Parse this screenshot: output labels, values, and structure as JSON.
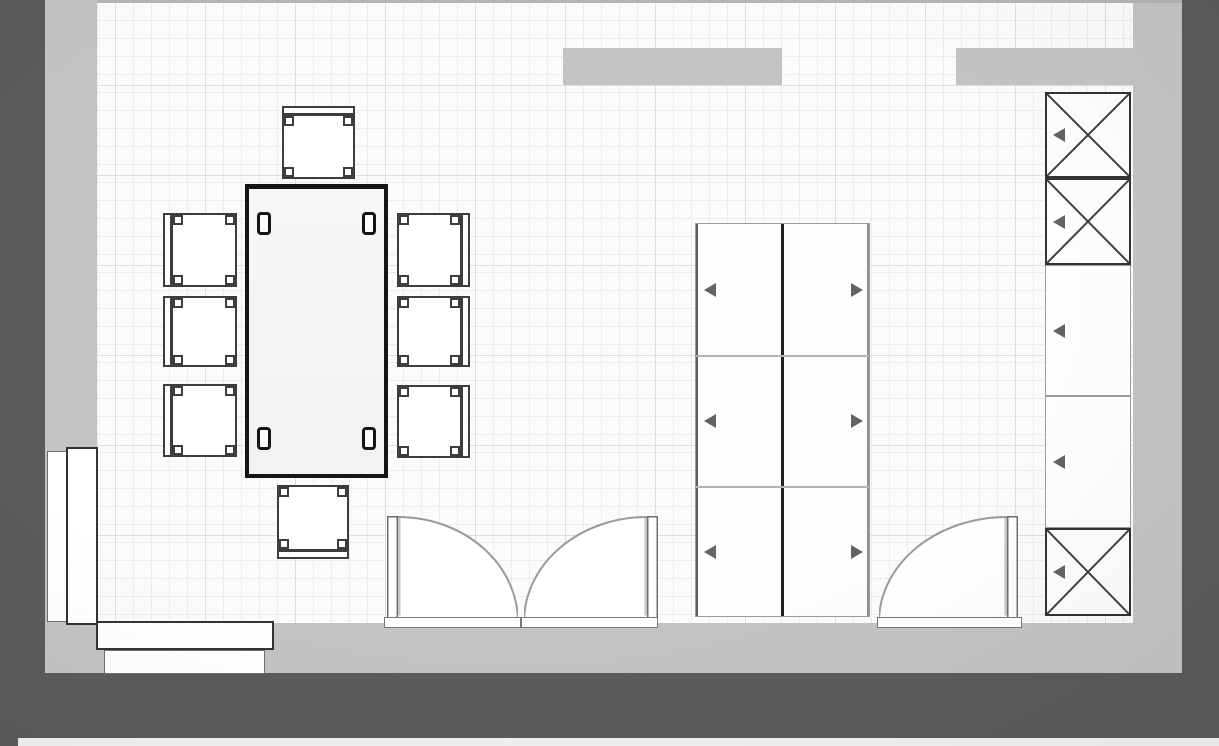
{
  "canvas": {
    "width": 1219,
    "height": 746
  },
  "colors": {
    "wall_dark": "#5b5b5b",
    "wall_light": "#c3c3c3",
    "soffit": "#c3c3c3",
    "floor": "#fbfbfb",
    "grid_minor": "#ececec",
    "grid_major": "#dedede",
    "top_edge_line": "#b4b4b4",
    "bottom_strip": "#f1f1ef",
    "outline_dark": "#333333",
    "outline_mid": "#9c9c9c",
    "table_border": "#151515",
    "table_fill": "#f6f6f5",
    "arrow": "#636363",
    "door_arc": "#9a9a9a",
    "door_leaf_border": "#6f6f6f",
    "leaf_shadow": "#b9b9b9",
    "white": "#ffffff"
  },
  "grid": {
    "minor_px": 18,
    "major_px": 90,
    "offset_x": 18,
    "offset_y": 83
  },
  "room": {
    "floor": {
      "x": 97,
      "y": 2,
      "w": 1036,
      "h": 621
    },
    "top_edge_line": {
      "x": 97,
      "y": 0,
      "w": 1085,
      "h": 3
    },
    "light_walls": [
      {
        "id": "wall-left",
        "x": 45,
        "y": 0,
        "w": 52,
        "h": 673
      },
      {
        "id": "wall-right",
        "x": 1133,
        "y": 0,
        "w": 49,
        "h": 673
      },
      {
        "id": "wall-bottom",
        "x": 45,
        "y": 623,
        "w": 1137,
        "h": 50
      }
    ],
    "dark_walls": [
      {
        "id": "outer-left",
        "x": 0,
        "y": 0,
        "w": 45,
        "h": 746
      },
      {
        "id": "outer-right",
        "x": 1182,
        "y": 0,
        "w": 37,
        "h": 738
      },
      {
        "id": "outer-bottom",
        "x": 0,
        "y": 673,
        "w": 1219,
        "h": 65
      }
    ],
    "bottom_strip": {
      "x": 18,
      "y": 738,
      "w": 1201,
      "h": 8
    }
  },
  "soffits": [
    {
      "id": "soffit-top-left",
      "x": 563,
      "y": 48,
      "w": 219,
      "h": 37
    },
    {
      "id": "soffit-top-right",
      "x": 956,
      "y": 48,
      "w": 226,
      "h": 37
    }
  ],
  "windows": {
    "left_wall": [
      {
        "x": 47,
        "y": 451,
        "w": 21,
        "h": 171,
        "border": "#6f6f6f",
        "bw": 1
      },
      {
        "x": 66,
        "y": 447,
        "w": 32,
        "h": 178,
        "border": "#333333",
        "bw": 2
      }
    ],
    "bottom_wall": [
      {
        "x": 96,
        "y": 621,
        "w": 178,
        "h": 29,
        "border": "#333333",
        "bw": 2
      },
      {
        "x": 104,
        "y": 650,
        "w": 161,
        "h": 24,
        "border": "#6f6f6f",
        "bw": 1
      }
    ]
  },
  "dining_set": {
    "table": {
      "x": 245,
      "y": 184,
      "w": 143,
      "h": 294,
      "border_w": 4,
      "border_top_w": 5
    },
    "legs": {
      "w": 14,
      "h": 23,
      "positions": [
        [
          12,
          28
        ],
        [
          117,
          28
        ],
        [
          12,
          243
        ],
        [
          117,
          243
        ]
      ]
    },
    "chairs": [
      {
        "id": "chair-top",
        "x": 282,
        "y": 106,
        "w": 73,
        "h": 73,
        "back": "top"
      },
      {
        "id": "chair-left-1",
        "x": 163,
        "y": 213,
        "w": 74,
        "h": 74,
        "back": "left"
      },
      {
        "id": "chair-left-2",
        "x": 163,
        "y": 296,
        "w": 74,
        "h": 71,
        "back": "left"
      },
      {
        "id": "chair-left-3",
        "x": 163,
        "y": 384,
        "w": 74,
        "h": 73,
        "back": "left"
      },
      {
        "id": "chair-right-1",
        "x": 397,
        "y": 213,
        "w": 73,
        "h": 74,
        "back": "right"
      },
      {
        "id": "chair-right-2",
        "x": 397,
        "y": 296,
        "w": 73,
        "h": 71,
        "back": "right"
      },
      {
        "id": "chair-right-3",
        "x": 397,
        "y": 385,
        "w": 73,
        "h": 73,
        "back": "right"
      },
      {
        "id": "chair-bottom",
        "x": 277,
        "y": 485,
        "w": 72,
        "h": 74,
        "back": "bottom"
      }
    ]
  },
  "wardrobe": {
    "id": "double-wardrobe",
    "x": 695,
    "y": 223,
    "w": 175,
    "h": 394,
    "row_dividers": [
      131,
      262
    ],
    "center_divider_w": 3,
    "arrows": {
      "left_column": {
        "dir": "left",
        "x_rel": 8,
        "y_centers": [
          66,
          197,
          328
        ]
      },
      "right_column": {
        "dir": "right",
        "x_rel": 155,
        "y_centers": [
          66,
          197,
          328
        ]
      }
    }
  },
  "tall_cabinet": {
    "id": "tall-cabinet-column",
    "x": 1045,
    "y": 92,
    "w": 86,
    "cells": [
      {
        "h": 86,
        "x_brace": true
      },
      {
        "h": 87,
        "x_brace": true
      },
      {
        "h": 131,
        "x_brace": false
      },
      {
        "h": 132,
        "x_brace": false
      },
      {
        "h": 88,
        "x_brace": true
      }
    ],
    "arrow": {
      "dir": "left",
      "x_rel": 8
    }
  },
  "doors": {
    "leaves": [
      {
        "id": "double-door-left-leaf",
        "x": 387,
        "y": 516,
        "w": 131,
        "h": 106,
        "hinge": "left"
      },
      {
        "id": "double-door-right-leaf",
        "x": 524,
        "y": 516,
        "w": 134,
        "h": 106,
        "hinge": "right"
      },
      {
        "id": "entry-door",
        "x": 879,
        "y": 516,
        "w": 139,
        "h": 106,
        "hinge": "right"
      }
    ],
    "thresholds": [
      {
        "x": 384,
        "y": 617,
        "w": 137,
        "h": 11
      },
      {
        "x": 521,
        "y": 617,
        "w": 137,
        "h": 11
      },
      {
        "x": 877,
        "y": 617,
        "w": 145,
        "h": 11
      }
    ],
    "leaf_thickness": 11
  }
}
